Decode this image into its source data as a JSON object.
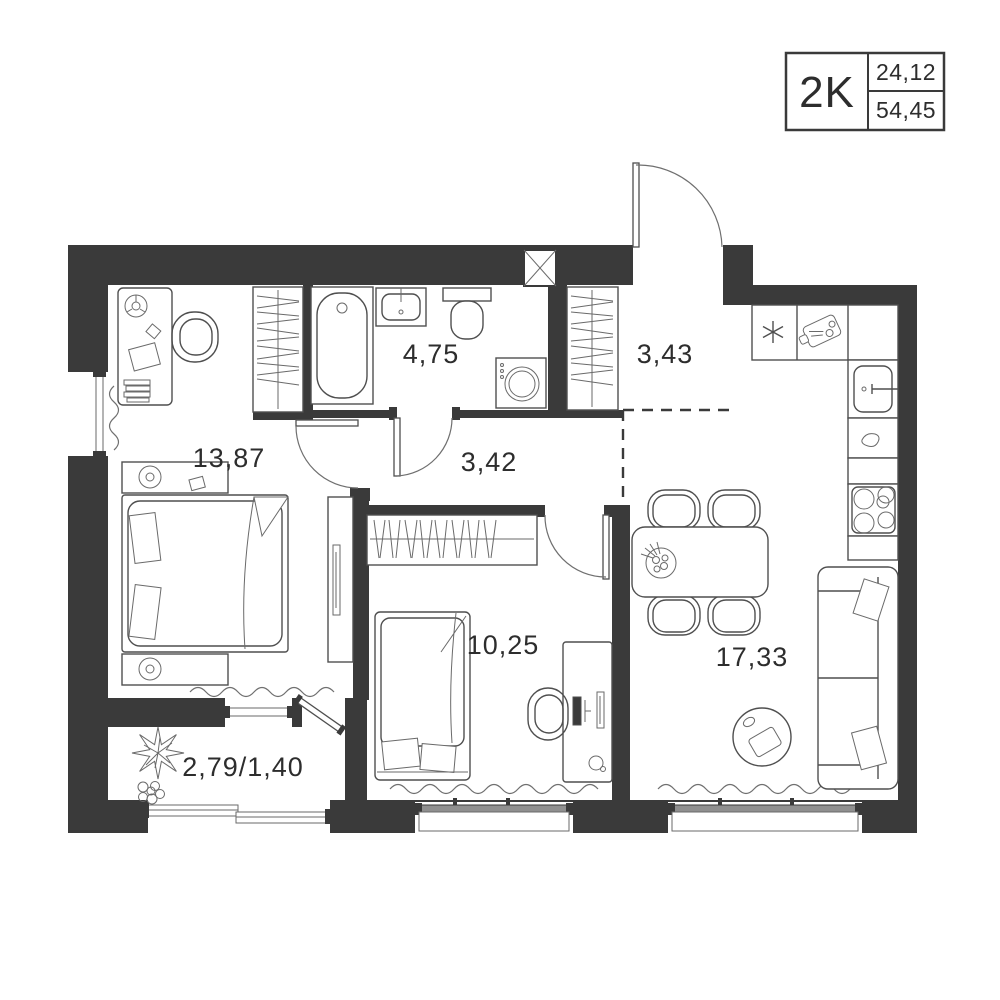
{
  "info_box": {
    "rooms_label": "2K",
    "value_top": "24,12",
    "value_bottom": "54,45"
  },
  "room_labels": {
    "bedroom_main": "13,87",
    "bathroom": "4,75",
    "entry_hall": "3,43",
    "hallway": "3,42",
    "bedroom_second": "10,25",
    "living_kitchen": "17,33",
    "balcony": "2,79/1,40"
  },
  "colors": {
    "wall": "#3a3a3a",
    "furniture_line": "#4f4f4f",
    "background": "#ffffff",
    "window_frame": "#8f8f8f",
    "label_text": "#2d2d2d"
  },
  "icons": [
    "bathtub-icon",
    "washbasin-icon",
    "toilet-icon",
    "washing-machine-icon",
    "vent-shaft-icon",
    "wardrobe-hangers-icon",
    "double-bed-icon",
    "single-bed-icon",
    "desk-icon",
    "chair-icon",
    "kitchen-sink-icon",
    "stove-icon",
    "cutting-board-icon",
    "fridge-asterisk-icon",
    "kettle-icon",
    "dining-table-icon",
    "fruit-bowl-icon",
    "sofa-icon",
    "coffee-table-icon",
    "plant-icon",
    "tv-stand-icon",
    "nightstand-lamp-icon",
    "entrance-door-icon",
    "window-icon",
    "radiator-icon"
  ]
}
